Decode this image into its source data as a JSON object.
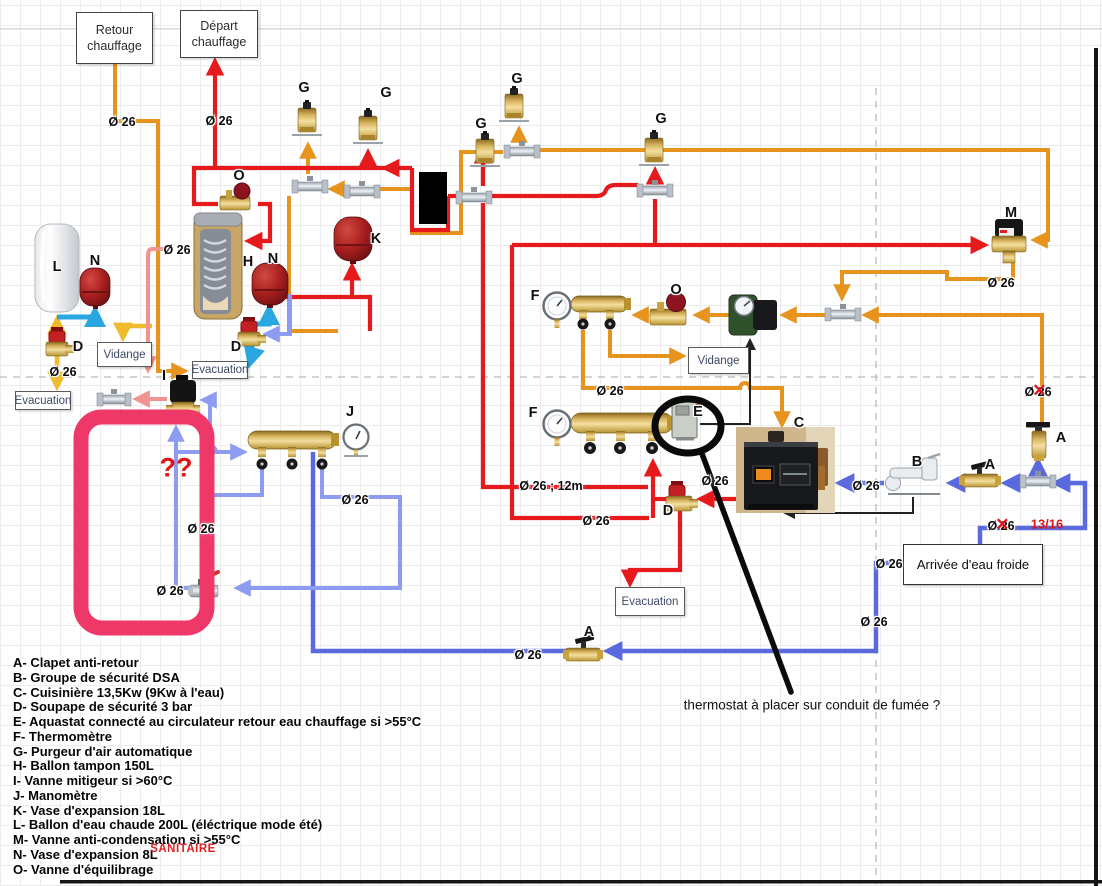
{
  "diagram": {
    "boxes": [
      {
        "id": "retour-chauffage",
        "text": "Retour chauffage",
        "x": 76,
        "y": 12,
        "w": 75,
        "h": 50,
        "style": "hdr"
      },
      {
        "id": "depart-chauffage",
        "text": "Départ chauffage",
        "x": 180,
        "y": 10,
        "w": 76,
        "h": 46,
        "style": "hdr"
      },
      {
        "id": "vidange-left",
        "text": "Vidange",
        "x": 97,
        "y": 342,
        "w": 53,
        "h": 23,
        "style": ""
      },
      {
        "id": "evacuation-left",
        "text": "Evacuation",
        "x": 15,
        "y": 391,
        "w": 54,
        "h": 17,
        "style": ""
      },
      {
        "id": "evacuation-mid",
        "text": "Evacuation",
        "x": 192,
        "y": 361,
        "w": 54,
        "h": 16,
        "style": ""
      },
      {
        "id": "vidange-right",
        "text": "Vidange",
        "x": 688,
        "y": 347,
        "w": 59,
        "h": 25,
        "style": ""
      },
      {
        "id": "evacuation-bottom",
        "text": "Evacuation",
        "x": 615,
        "y": 587,
        "w": 68,
        "h": 27,
        "style": ""
      },
      {
        "id": "arrivee-eau-froide",
        "text": "Arrivée d'eau froide",
        "x": 903,
        "y": 544,
        "w": 138,
        "h": 39,
        "style": "arr"
      }
    ],
    "pipe_labels": [
      {
        "text": "Ø 26",
        "x": 122,
        "y": 122,
        "crossed": false
      },
      {
        "text": "Ø 26",
        "x": 219,
        "y": 121,
        "crossed": false
      },
      {
        "text": "Ø 26",
        "x": 177,
        "y": 250,
        "crossed": false
      },
      {
        "text": "Ø 26",
        "x": 63,
        "y": 372,
        "crossed": false
      },
      {
        "text": "Ø 26",
        "x": 201,
        "y": 529,
        "crossed": false
      },
      {
        "text": "Ø 26",
        "x": 170,
        "y": 591,
        "crossed": false
      },
      {
        "text": "Ø 26",
        "x": 355,
        "y": 500,
        "crossed": false
      },
      {
        "text": "Ø 26",
        "x": 610,
        "y": 391,
        "crossed": false
      },
      {
        "text": "Ø 26 ; 12m",
        "x": 551,
        "y": 486,
        "crossed": false
      },
      {
        "text": "Ø 26",
        "x": 596,
        "y": 521,
        "crossed": false
      },
      {
        "text": "Ø 26",
        "x": 715,
        "y": 481,
        "crossed": false
      },
      {
        "text": "Ø 26",
        "x": 866,
        "y": 486,
        "crossed": false
      },
      {
        "text": "Ø 26",
        "x": 1001,
        "y": 283,
        "crossed": false
      },
      {
        "text": "Ø 26",
        "x": 1038,
        "y": 392,
        "crossed": true
      },
      {
        "text": "Ø 26",
        "x": 1001,
        "y": 526,
        "crossed": true
      },
      {
        "text": "Ø 26",
        "x": 889,
        "y": 564,
        "crossed": false
      },
      {
        "text": "Ø 26",
        "x": 874,
        "y": 622,
        "crossed": false
      },
      {
        "text": "Ø 26",
        "x": 528,
        "y": 655,
        "crossed": false
      }
    ],
    "component_letters": [
      {
        "letter": "G",
        "x": 304,
        "y": 88
      },
      {
        "letter": "G",
        "x": 386,
        "y": 93
      },
      {
        "letter": "G",
        "x": 481,
        "y": 124
      },
      {
        "letter": "G",
        "x": 517,
        "y": 79
      },
      {
        "letter": "G",
        "x": 661,
        "y": 119
      },
      {
        "letter": "O",
        "x": 239,
        "y": 176
      },
      {
        "letter": "O",
        "x": 676,
        "y": 290
      },
      {
        "letter": "M",
        "x": 1011,
        "y": 213
      },
      {
        "letter": "K",
        "x": 376,
        "y": 239
      },
      {
        "letter": "H",
        "x": 248,
        "y": 262
      },
      {
        "letter": "N",
        "x": 273,
        "y": 259
      },
      {
        "letter": "N",
        "x": 95,
        "y": 261
      },
      {
        "letter": "L",
        "x": 57,
        "y": 267
      },
      {
        "letter": "D",
        "x": 78,
        "y": 347
      },
      {
        "letter": "D",
        "x": 236,
        "y": 347
      },
      {
        "letter": "D",
        "x": 668,
        "y": 511
      },
      {
        "letter": "I",
        "x": 164,
        "y": 376
      },
      {
        "letter": "J",
        "x": 350,
        "y": 412
      },
      {
        "letter": "F",
        "x": 535,
        "y": 296
      },
      {
        "letter": "F",
        "x": 533,
        "y": 413
      },
      {
        "letter": "E",
        "x": 698,
        "y": 412
      },
      {
        "letter": "C",
        "x": 799,
        "y": 423
      },
      {
        "letter": "B",
        "x": 917,
        "y": 462
      },
      {
        "letter": "A",
        "x": 589,
        "y": 632
      },
      {
        "letter": "A",
        "x": 990,
        "y": 465
      },
      {
        "letter": "A",
        "x": 1061,
        "y": 438
      }
    ],
    "legend": {
      "items": [
        "A- Clapet anti-retour",
        "B- Groupe de sécurité DSA",
        "C- Cuisinière 13,5Kw (9Kw à l'eau)",
        "D- Soupape de sécurité 3 bar",
        "E- Aquastat connecté au circulateur retour eau chauffage si >55°C",
        "F- Thermomètre",
        "G- Purgeur d'air automatique",
        "H- Ballon tampon 150L",
        "I- Vanne mitigeur si >60°C",
        "J- Manomètre",
        "K- Vase d'expansion 18L",
        "L- Ballon d'eau chaude 200L (éléctrique mode été)",
        "M- Vanne anti-condensation si >55°C",
        "N- Vase d'expansion 8L",
        "O- Vanne d'équilibrage"
      ]
    },
    "annotations": [
      {
        "id": "question-marks",
        "text": "??",
        "x": 176,
        "y": 468,
        "style": "qq"
      },
      {
        "id": "pipe-ratio",
        "text": "13/16",
        "x": 1047,
        "y": 524,
        "style": "ratio"
      },
      {
        "id": "sanitaire",
        "text": "SANITAIRE",
        "x": 183,
        "y": 849,
        "style": "sanitaire"
      },
      {
        "id": "thermostat-note",
        "text": "thermostat à placer sur conduit de fumée ?",
        "x": 812,
        "y": 705,
        "style": "thermo"
      }
    ],
    "colors": {
      "pipe_red": "#e6191c",
      "pipe_orange": "#e6941e",
      "pipe_blue": "#5a6ade",
      "pipe_light_blue": "#8d9cf0",
      "pipe_cyan": "#2aa7e0",
      "pipe_yellow": "#eebb2d",
      "pipe_salmon": "#f2938f",
      "highlight_pink": "#ee3968",
      "annotation_red": "#e01616"
    }
  }
}
